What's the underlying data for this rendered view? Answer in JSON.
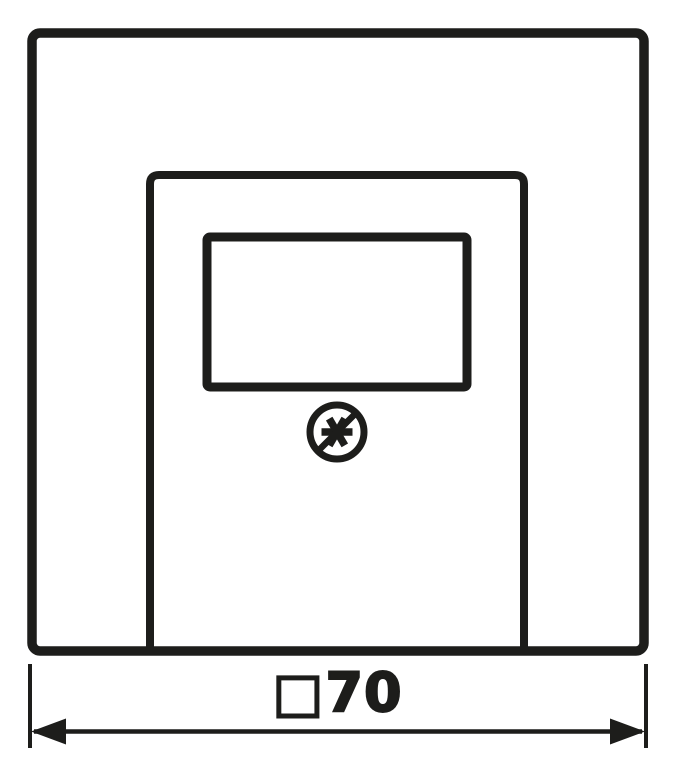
{
  "drawing": {
    "type": "technical-dimension-drawing",
    "subject": "square cover plate with TAE socket opening and screw symbol",
    "colors": {
      "line": "#1d1d1b",
      "background": "#ffffff"
    },
    "screw_symbol": {
      "icon": "screw-fixing-icon",
      "description": "circle with six-spoke asterisk crossed by diagonal slash"
    },
    "dimension": {
      "symbol": "□",
      "value": "70",
      "label": "□70"
    }
  }
}
